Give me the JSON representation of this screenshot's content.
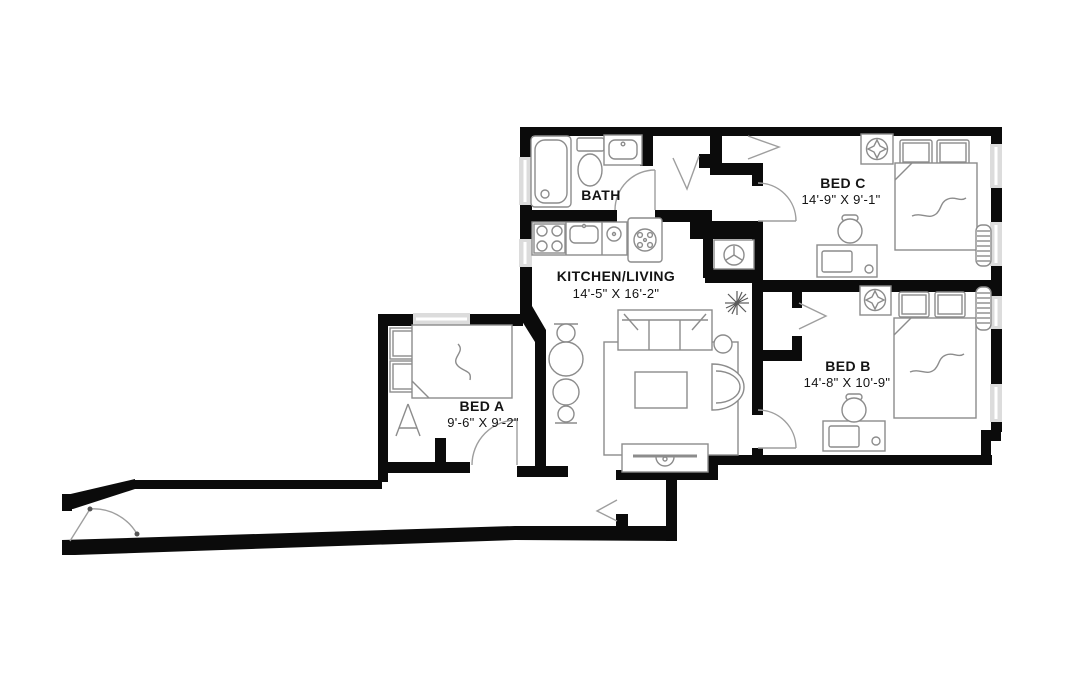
{
  "rooms": {
    "bath": {
      "label": "BATH"
    },
    "kitchen_living": {
      "label": "KITCHEN/LIVING",
      "dims": "14'-5\" X 16'-2\""
    },
    "bed_a": {
      "label": "BED A",
      "dims": "9'-6\" X 9'-2\""
    },
    "bed_b": {
      "label": "BED B",
      "dims": "14'-8\" X 10'-9\""
    },
    "bed_c": {
      "label": "BED C",
      "dims": "14'-9\" X 9'-1\""
    }
  },
  "colors": {
    "wall": "#0b0b0b",
    "fixture": "#8c8c8c",
    "door": "#9e9e9e",
    "window": "#dcdcdc",
    "label": "#141414",
    "background": "#ffffff"
  },
  "icons": [
    "bathtub-icon",
    "toilet-icon",
    "vanity-sink-icon",
    "stove-icon",
    "kitchen-sink-icon",
    "washer-icon",
    "range-icon",
    "water-heater-icon",
    "ceiling-fan-icon",
    "radiator-icon",
    "door-swing-icon",
    "closet-chevron-icon",
    "sofa-icon",
    "armchair-icon",
    "coffee-table-icon",
    "rug-icon",
    "tv-console-icon",
    "dining-set-icon",
    "plant-icon",
    "bed-icon",
    "pillow-icon",
    "desk-icon",
    "office-chair-icon",
    "easel-icon",
    "entry-door-icon",
    "window-marker"
  ]
}
